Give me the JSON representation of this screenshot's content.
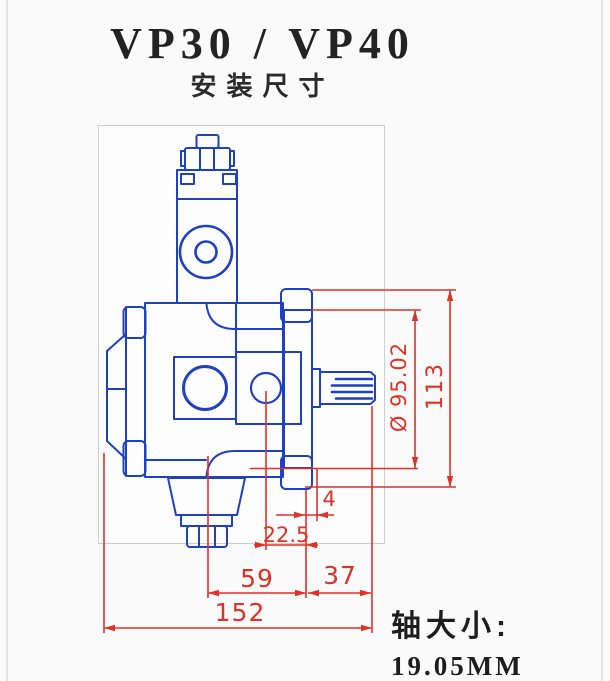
{
  "header": {
    "title": "VP30 / VP40",
    "subtitle": "安装尺寸"
  },
  "drawing": {
    "kind": "pump-installation-dimension-drawing",
    "colors": {
      "outline": "#1e41c4",
      "dimension": "#df3128",
      "frame": "#cfcfcf"
    },
    "dimensions": {
      "flange_spigot_diameter": "Ø 95.02",
      "flange_overall_height": "113",
      "flange_plate_thickness": "4",
      "port_center_to_mount_face": "22.5",
      "pump_center_to_mount_face": "59",
      "mount_face_to_shaft_end": "37",
      "overall_length": "152"
    }
  },
  "footer": {
    "shaft_size_label": "轴大小:",
    "shaft_size_value": "19.05MM"
  }
}
